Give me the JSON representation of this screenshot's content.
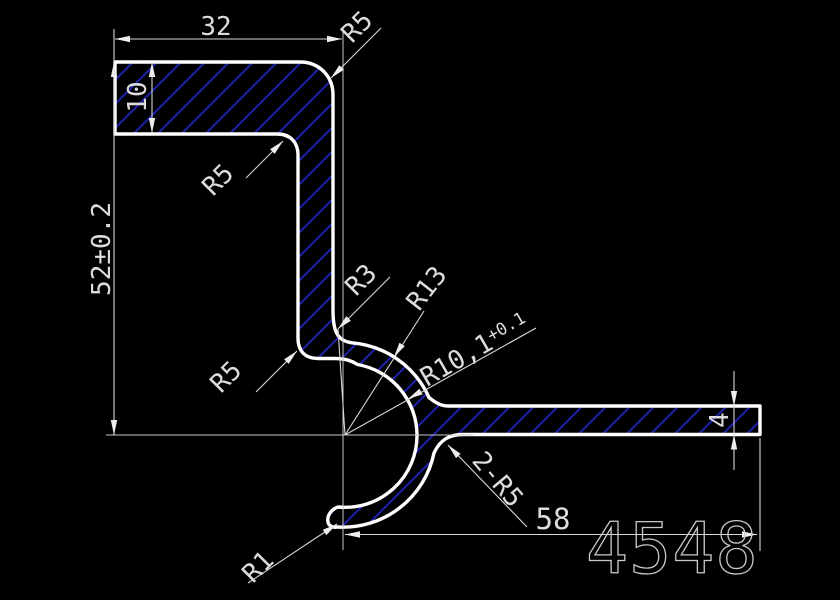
{
  "drawing": {
    "labels": {
      "dim_width_top": "32",
      "dim_flange_top_thickness": "10",
      "dim_height": "52±0.2",
      "r_outer_top": "R5",
      "r_inner_flange": "R5",
      "r_inner_hook": "R5",
      "r3": "R3",
      "r13": "R13",
      "r_bore_main": "R10,1",
      "r_bore_tol": "+0.1",
      "r_hook_fillets": "2-R5",
      "dim_length_bottom": "58",
      "dim_flange_bottom_thickness": "4",
      "r_tip": "R1",
      "part_number": "4548"
    },
    "colors": {
      "background": "#000000",
      "outline": "#ffffff",
      "dimension": "#d8d8d8",
      "hatch": "#2424c8"
    }
  }
}
